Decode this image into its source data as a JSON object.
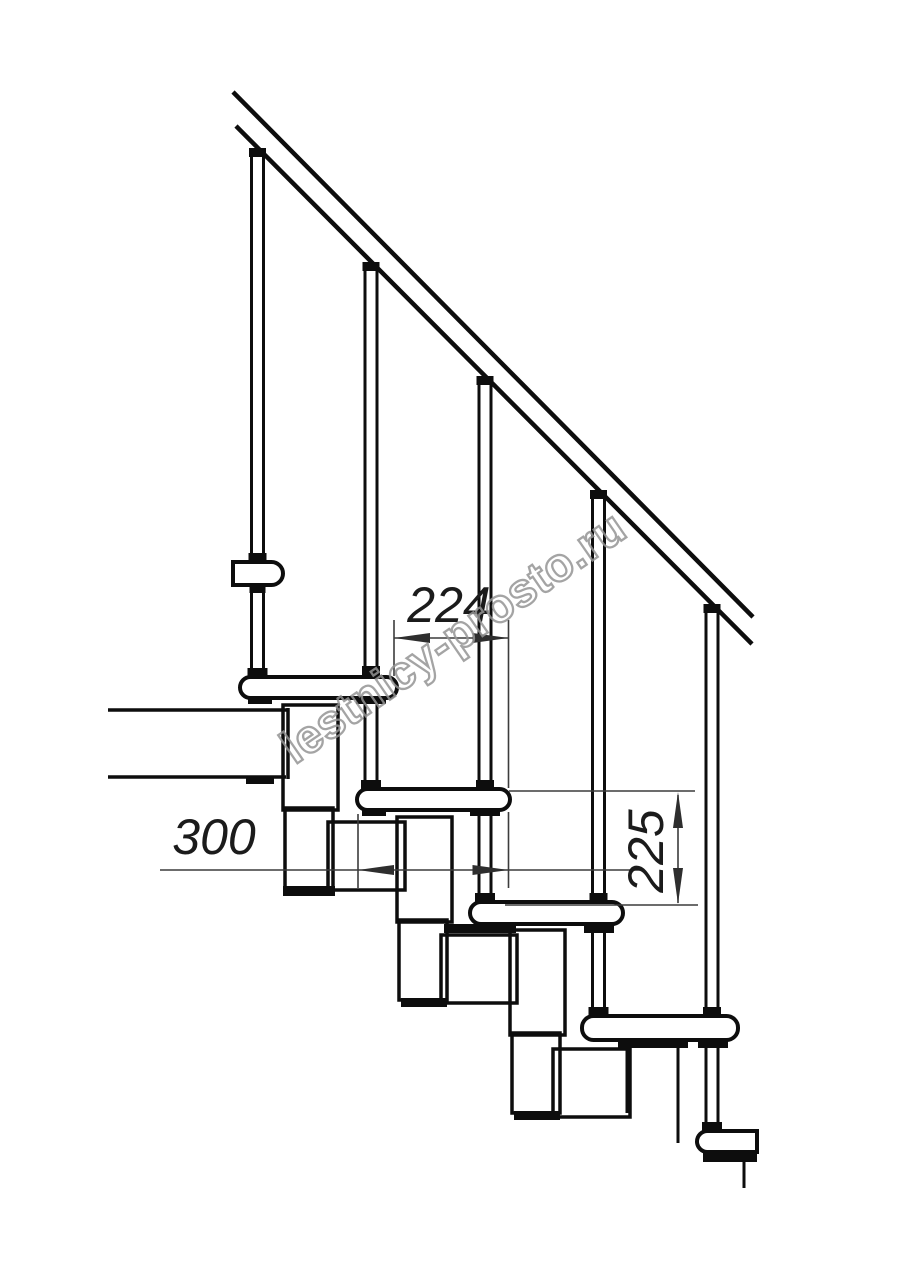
{
  "drawing": {
    "type": "technical-drawing",
    "subject": "modular staircase side elevation",
    "background_color": "#ffffff",
    "line_color": "#0d0d0d",
    "dimension_line_color": "#3c3c3c",
    "dimensions": {
      "going": {
        "label": "224",
        "orientation": "horizontal"
      },
      "tread_length": {
        "label": "300",
        "orientation": "horizontal"
      },
      "riser_height": {
        "label": "225",
        "orientation": "vertical"
      }
    },
    "elements": {
      "handrail_count": 1,
      "baluster_count": 5,
      "tread_count": 6,
      "support_module_count": 4
    }
  },
  "watermark": {
    "text": "lestnicy-prosto.ru",
    "color": "#949494"
  }
}
